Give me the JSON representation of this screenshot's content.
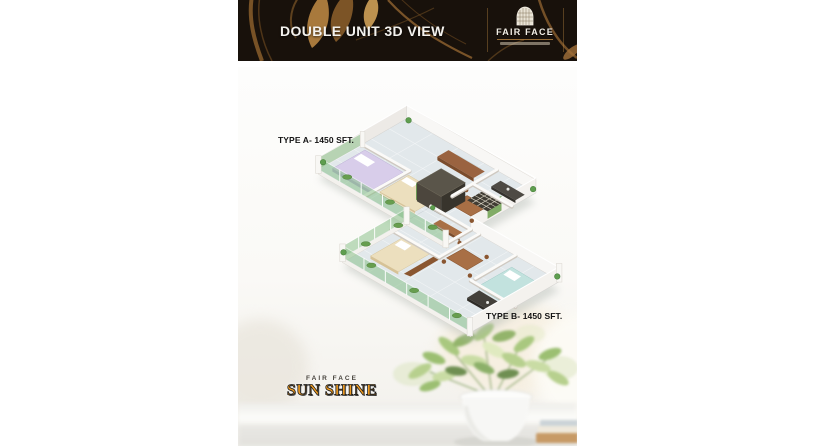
{
  "header": {
    "title": "DOUBLE UNIT 3D VIEW",
    "brand": {
      "name": "FAIR FACE"
    }
  },
  "plan": {
    "type_a_label": "TYPE A- 1450 SFT.",
    "type_b_label": "TYPE B- 1450 SFT."
  },
  "brand_footer": {
    "top_label": "FAIR FACE",
    "main_label": "SUN SHINE"
  },
  "icons": {
    "header_brand": "building-grid-icon",
    "floorplan": "isometric-floorplan-3d-render",
    "photo": "potted-plant-windowsill-photo"
  },
  "colors": {
    "header_background": "#18110b",
    "header_gold": "#c08b45",
    "title_text": "#f4f2ee",
    "sunshine_gold": "#f09c22",
    "label_text": "#141414",
    "balcony_glass": "#7db87d",
    "wood_furniture": "#a86f45",
    "floor_tile": "#e2e8eb"
  }
}
